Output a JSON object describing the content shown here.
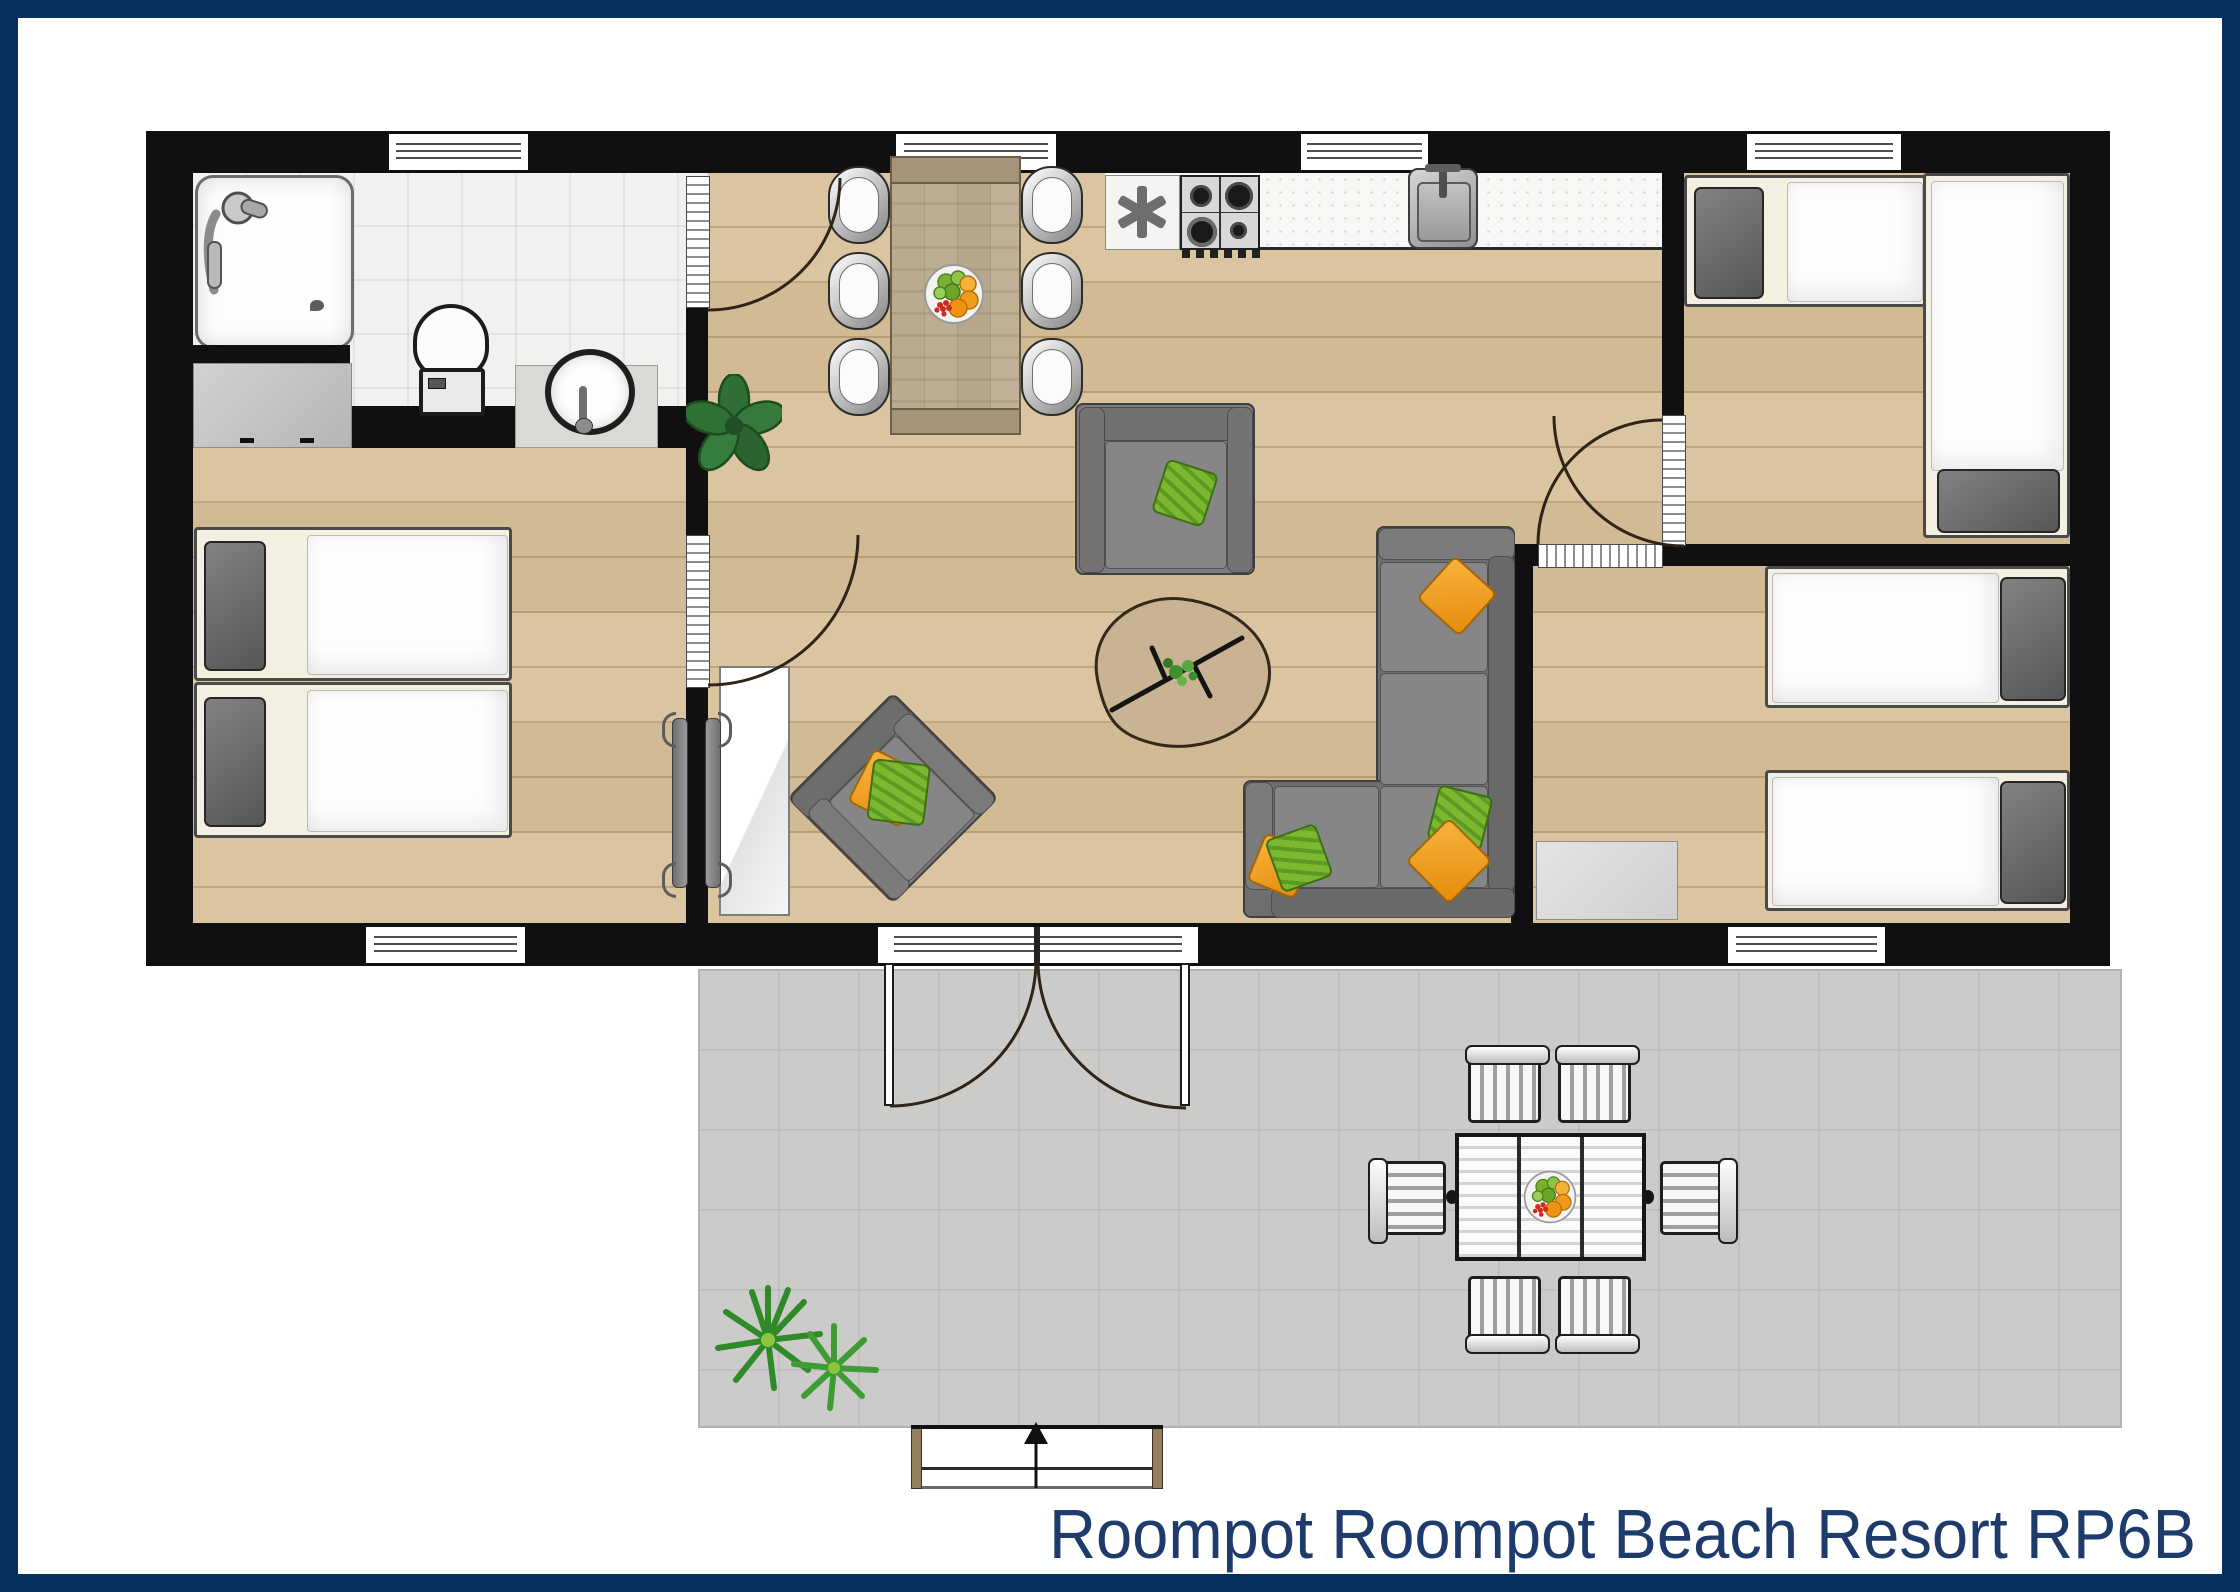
{
  "title": "Roompot Roompot Beach Resort RP6B",
  "colors": {
    "frame": "#06305c",
    "title": "#1d3c6b",
    "wall": "#101010",
    "wood": "#d9c19b",
    "tile": "#f1f1f0",
    "terrace": "#cbcbca",
    "cream": "#f3f0e2",
    "green": "#78b42d",
    "orange": "#f2a01f"
  },
  "icons": {
    "freezer-star-icon": "✳",
    "entrance-arrow-icon": "↑"
  }
}
